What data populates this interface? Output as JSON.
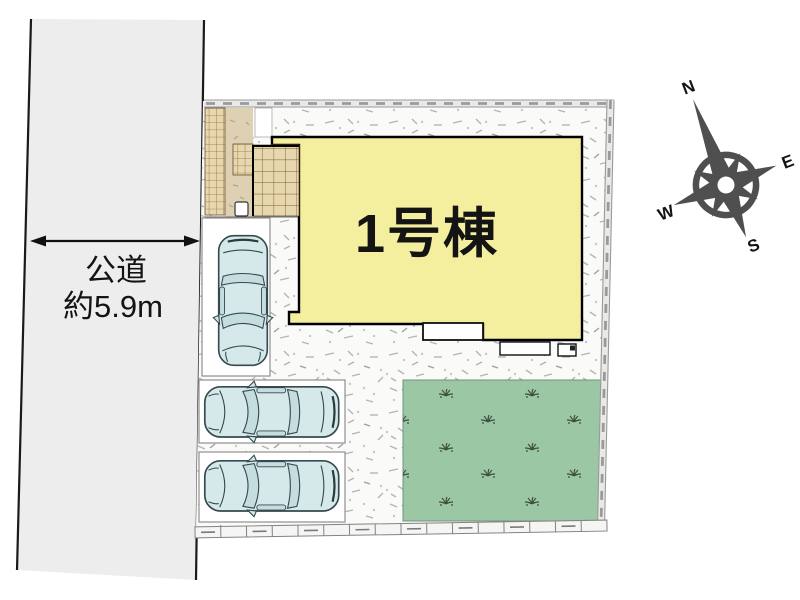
{
  "road": {
    "name": "公道",
    "width": "約5.9m"
  },
  "building": {
    "name": "1号棟"
  },
  "compass": {
    "north": "N",
    "east": "E",
    "south": "S",
    "west": "W"
  },
  "parking": {
    "space_count": 3
  },
  "colors": {
    "road": "#ededed",
    "building": "#f4ef9e",
    "lawn": "#9cc7a4",
    "car": "#d6e9ea",
    "approach_tile": "#e7d7ae",
    "compass": "#4f4f4f"
  }
}
